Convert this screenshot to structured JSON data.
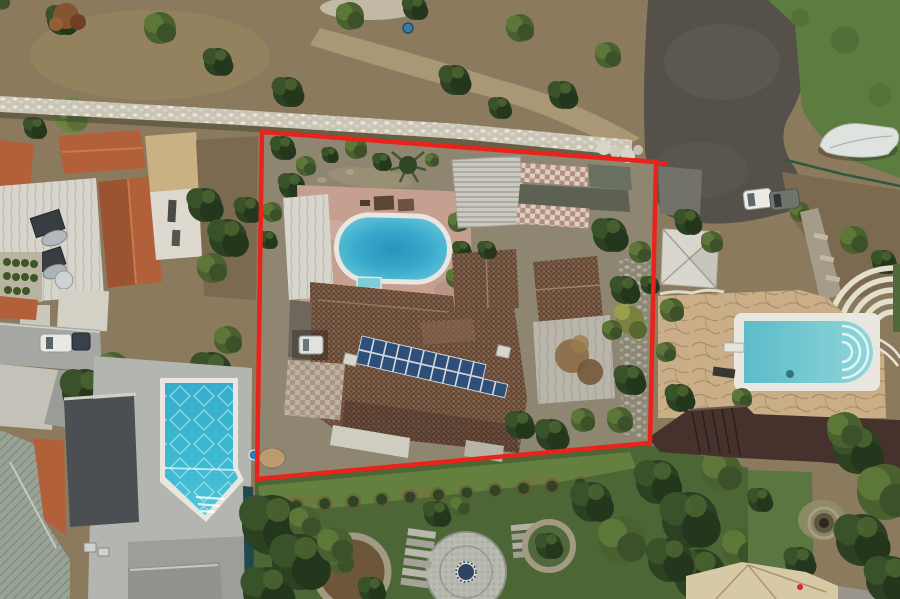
{
  "scene": {
    "type": "aerial-drone-photograph",
    "subject": "Top-down aerial view of a villa plot outlined in red: terracotta-roof house with rooftop solar panels and oval pool, neighbouring houses with pools, gardens, olive scrubland and an access road",
    "boundary_corners": "262,132 656,162 650,443 257,479"
  },
  "colors": {
    "red_boundary": "#e8231b",
    "dirt_field": "#8c7a5e",
    "dirt_yard": "#7b6a50",
    "stone_wall": "#c9c4b4",
    "road_asphalt": "#55504a",
    "grass": "#5d7c40",
    "boat_cover": "#dfe3df",
    "left_pool_water": "#3ab4cf",
    "oval_pool_rim": "#e8e6df",
    "neighbor_pool_water": "#72c8d2",
    "pool_deck_pink": "#c5a091",
    "concrete_deck": "#b3b5b0",
    "roof_brown": "#7b5a45",
    "solar_panel_blue": "#2e4f78",
    "white_roof": "#d7d5cc",
    "orange_roof": "#b2603a",
    "metal_roof": "#98a396",
    "dark_flat_roof": "#4b4f53",
    "flagstone": "#c9ae87",
    "garden_green": "#4d6636",
    "lawn_green": "#64803f",
    "dark_wall": "#46312c",
    "teal_fence": "#20494c",
    "circular_patio": "#b7b8ae",
    "patio_emblem": "#2f4460",
    "tan_roof": "#d8c9a6",
    "pergola_white": "#ccc9c0",
    "sail_white": "#d9d6cd",
    "moss_concrete": "#5c6153",
    "white_terrace": "#b9b5aa",
    "interior_ground": "#8f8672",
    "street_gray": "#a6a7a2",
    "shed_gray": "#90938e",
    "courtyard_tan": "#c9b183"
  },
  "solar_array": {
    "rows": [
      10,
      12
    ]
  },
  "garden": {
    "bush_row_count": 12
  }
}
